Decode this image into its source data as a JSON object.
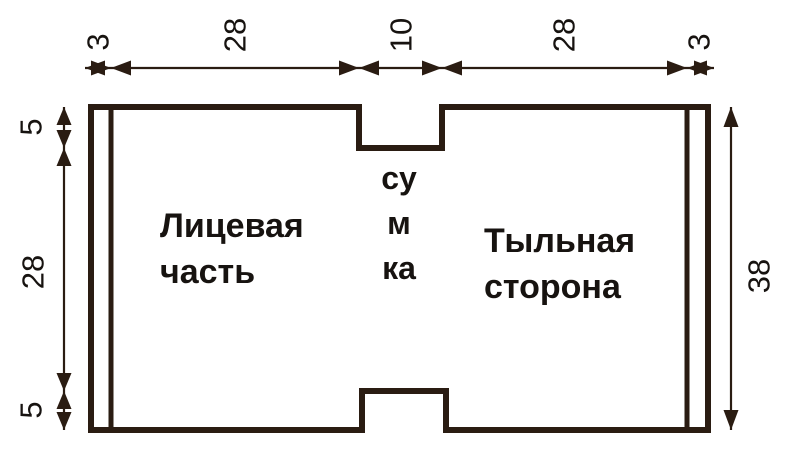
{
  "labels": {
    "front_panel": {
      "line1": "Лицевая",
      "line2": "часть"
    },
    "back_panel": {
      "line1": "Тыльная",
      "line2": "сторона"
    },
    "center_vertical": "сумка"
  },
  "dimensions": {
    "top": [
      "3",
      "28",
      "10",
      "28",
      "3"
    ],
    "left": [
      "5",
      "28",
      "5"
    ],
    "right": [
      "38"
    ]
  },
  "colors": {
    "line": "#2a1c12",
    "text": "#171310",
    "background": "#ffffff"
  }
}
